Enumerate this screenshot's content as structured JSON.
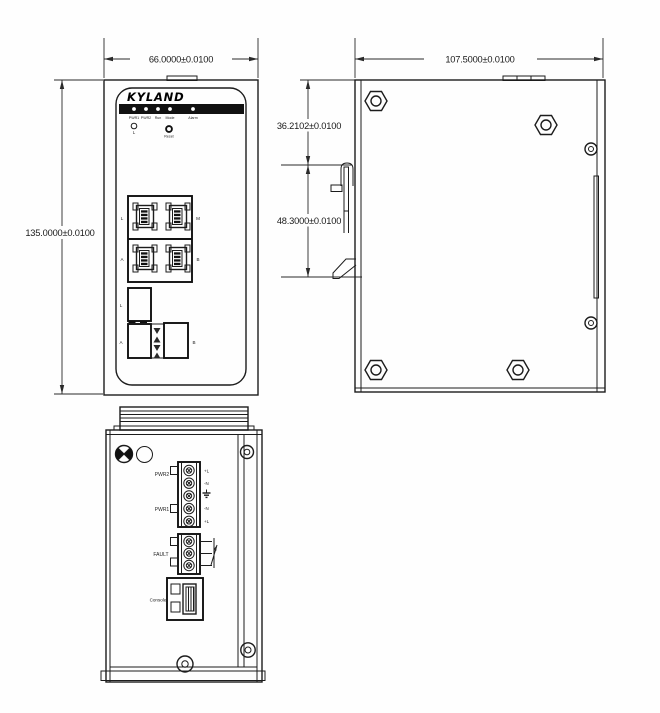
{
  "title": "Kyland industrial switch dimensional drawing",
  "colors": {
    "line": "#1c1c1c",
    "background": "#fefefe",
    "led_bar": "#111111"
  },
  "front_view": {
    "brand": "KYLAND",
    "led_labels": [
      "PWR1",
      "PWR2",
      "Run",
      "Mode",
      "Alarm"
    ],
    "link_led_label": "L",
    "reset_label": "Reset",
    "rj45_labels": {
      "top_left": "L",
      "top_right": "M",
      "bottom_left": "A",
      "bottom_right": "B"
    },
    "fiber_labels": {
      "top": "L",
      "left": "A",
      "right": "B"
    },
    "dim_width": "66.0000±0.0100",
    "dim_height": "135.0000±0.0100"
  },
  "side_view": {
    "dim_depth": "107.5000±0.0100",
    "dim_clip_offset": "36.2102±0.0100",
    "dim_clip_span": "48.3000±0.0100"
  },
  "bottom_view": {
    "power2_label": "PWR2",
    "power1_label": "PWR1",
    "fault_label": "FAULT",
    "console_label": "Console",
    "terminal_pin_labels": [
      "+L",
      "-N",
      "-N",
      "+L"
    ]
  }
}
